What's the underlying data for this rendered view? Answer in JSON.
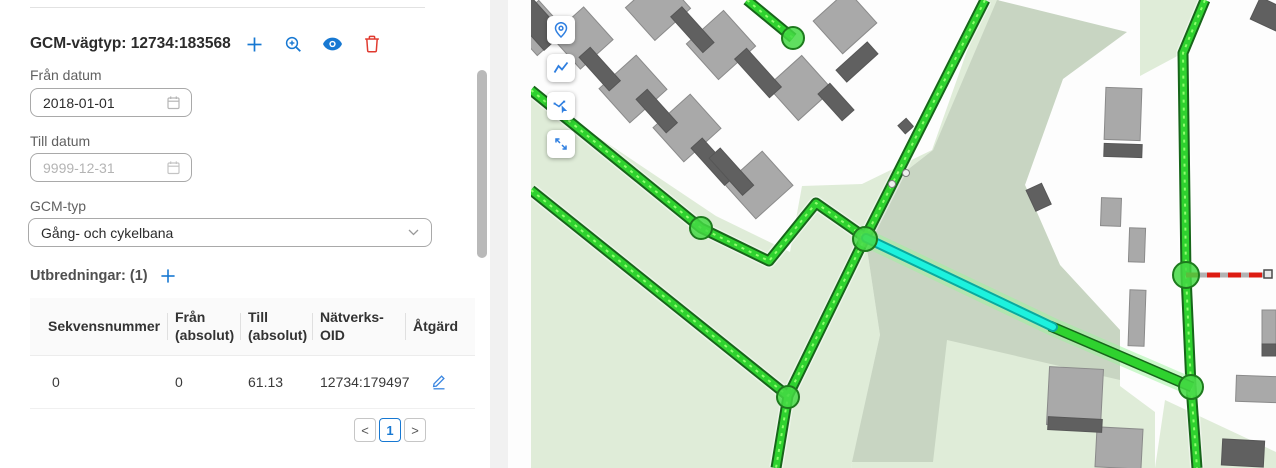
{
  "panel": {
    "colors": {
      "accent_blue": "#1778d2",
      "danger_red": "#e03a2f",
      "text_dark": "#2b2b2b",
      "text_label": "#616161",
      "border": "#a9a9a9"
    },
    "title": "GCM-vägtyp: 12734:183568",
    "toolbar": [
      {
        "icon": "plus-icon",
        "action": "add"
      },
      {
        "icon": "zoom-in-icon",
        "action": "zoom-to-feature"
      },
      {
        "icon": "eye-icon",
        "action": "show-feature"
      },
      {
        "icon": "trash-icon",
        "action": "delete-feature"
      }
    ],
    "fields": {
      "from_date": {
        "label": "Från datum",
        "value": "2018-01-01",
        "icon": "calendar-icon"
      },
      "to_date": {
        "label": "Till datum",
        "value": "9999-12-31",
        "icon": "calendar-icon"
      },
      "gcm_type": {
        "label": "GCM-typ",
        "value": "Gång- och cykelbana",
        "icon": "chevron-down-icon"
      }
    },
    "extents": {
      "heading": "Utbredningar: (1)",
      "add_icon": "plus-icon",
      "table": {
        "headers": [
          "Sekvensnummer",
          "Från (absolut)",
          "Till (absolut)",
          "Nätverks-OID",
          "Åtgärd"
        ],
        "rows": [
          {
            "sekvensnummer": "0",
            "fran": "0",
            "till": "61.13",
            "natverks_oid": "12734:179497",
            "action_icon": "edit-pencil-icon"
          }
        ]
      },
      "pagination": {
        "prev": "<",
        "current": "1",
        "next": ">"
      }
    }
  },
  "map": {
    "colors": {
      "land_green": "#dfecd8",
      "land_sage": "#c8d5c2",
      "building_light": "#a9a9a9",
      "building_dark": "#606060",
      "road_green": "#2fd22f",
      "road_casing": "#17661a",
      "road_dash": "#8dff6e",
      "glow_green": "#9cf59c",
      "selected_cyan": "#1df2de",
      "cyan_dark": "#0aa99e",
      "node_fill": "#44d944",
      "node_stroke": "#1d7a1d",
      "red_dashed": "#dd1c12",
      "toolbar_blue": "#2f7fe0"
    },
    "toolbar": [
      {
        "icon": "location-pin-icon"
      },
      {
        "icon": "polyline-icon"
      },
      {
        "icon": "select-line-icon"
      },
      {
        "icon": "expand-arrows-icon"
      }
    ]
  }
}
